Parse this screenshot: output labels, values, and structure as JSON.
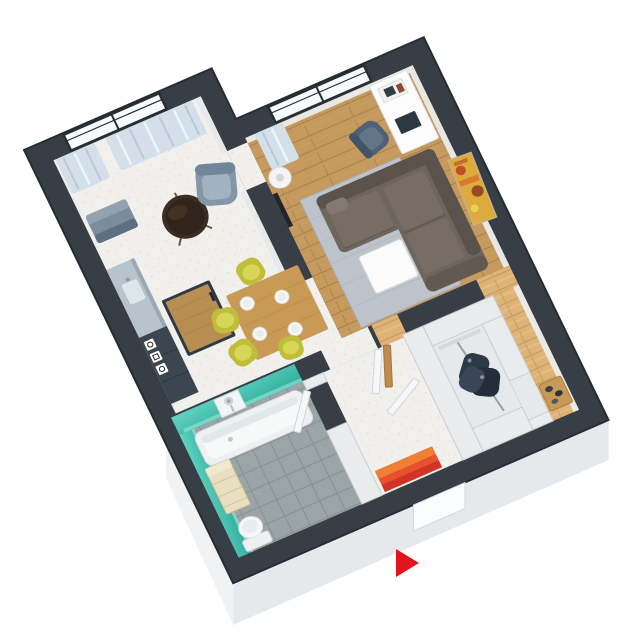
{
  "scene": {
    "description": "3D isometric render of a one-bedroom apartment floor plan on a white background",
    "background": "#ffffff",
    "view": "axonometric, rotated about -26 degrees"
  },
  "colors": {
    "wall": "#373e46",
    "wallEdge": "#262c33",
    "wallFace": "#edeff1",
    "partition": "#e9ebed",
    "floorWhite": "#f1f0ec",
    "floorWood": "#c59a5f",
    "floorWoodEntry": "#ddb377",
    "tile": "#9ba4a6",
    "tealWallLight": "#63d2c2",
    "tealWallDark": "#2fae9d",
    "rug": "#bcc3ca",
    "sofa": "#6e655c",
    "sofaBack": "#5b534b",
    "sofaCushion": "#776d63",
    "coffeeTable": "#fbfbfb",
    "curtain": "#d3dfe9",
    "windowGlass": "#f8fbfd",
    "windowFrame": "#272e34",
    "armchair": "#8496a7",
    "sideTable": "#3a2d22",
    "benchSeat": "#7b8c9d",
    "desk": "#fcfcfc",
    "deskChair": "#4f6376",
    "floorLamp": "#f4f4f4",
    "counter": "#b7c3cd",
    "appliance": "#3b4650",
    "islandBase": "#2e3a46",
    "islandTop": "#b98e52",
    "diningTable": "#c89a55",
    "chairLime": "#c0bd3a",
    "plate": "#f7f7f5",
    "tub": "#f7f9f9",
    "bathCabinet": "#e9dfc2",
    "toilet": "#f6f8f8",
    "doorPanel": "#f6f7f8",
    "doorWood": "#c08b4e",
    "matRed": "#e8502e",
    "matOrange": "#ef7f33",
    "matDark": "#cf3527",
    "clothes": "#2c3947",
    "closetFloor": "#e6e9eb",
    "shoeBench": "#c79a58",
    "paintingBase": "#ddab3c",
    "paintingAccent": "#c24e2a",
    "skirtEast": "#eceff1",
    "skirtSouth": "#e6e9eb",
    "skirtWest": "#f0f2f4",
    "arrow": "#e3141c",
    "tv": "#20262c"
  },
  "rooms": [
    {
      "id": "bedroom-nook",
      "items": [
        "window",
        "curtains",
        "armchair",
        "round-side-table",
        "bench-seat"
      ]
    },
    {
      "id": "living-room",
      "items": [
        "window",
        "curtain",
        "floor-lamp",
        "desk",
        "desk-chair",
        "corner-sofa",
        "coffee-table",
        "rug",
        "painting",
        "tv-panel"
      ]
    },
    {
      "id": "kitchen-dining",
      "items": [
        "counter",
        "sink",
        "appliance-column",
        "wall-decals",
        "island",
        "dining-table",
        "plates",
        "four-lime-chairs"
      ]
    },
    {
      "id": "bathroom",
      "items": [
        "bathtub",
        "shower-panel",
        "cabinet",
        "toilet",
        "teal-walls",
        "tile-floor",
        "door"
      ]
    },
    {
      "id": "hallway",
      "items": [
        "open-doors",
        "wooden-door",
        "striped-doormat",
        "entrance-door"
      ]
    },
    {
      "id": "closet",
      "items": [
        "clothes-rail",
        "hanging-clothes",
        "shelf"
      ]
    },
    {
      "id": "entry-corridor",
      "items": [
        "shoe-bench",
        "shoes"
      ]
    }
  ],
  "indicator": {
    "name": "entrance-arrow",
    "direction": "right",
    "color": "#e3141c"
  }
}
